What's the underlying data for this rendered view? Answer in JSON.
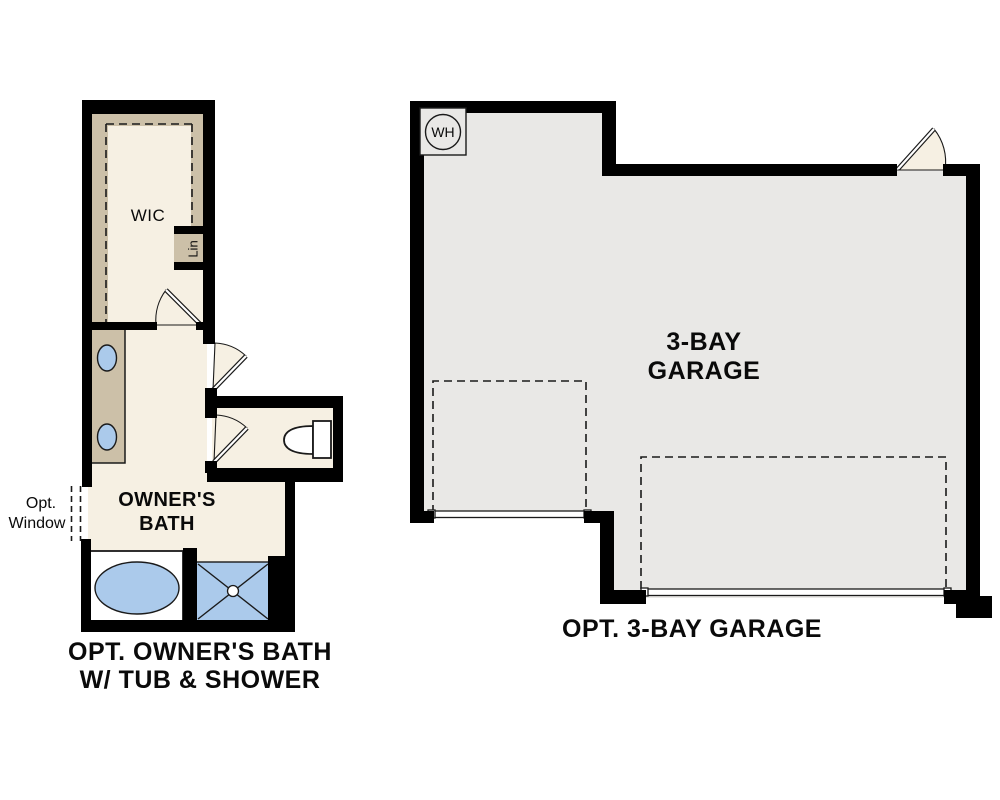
{
  "colors": {
    "wall": "#000000",
    "line-dark": "#1a1a1a",
    "floor-cream": "#f6f0e3",
    "closet-tan": "#ccc0a8",
    "garage-gray": "#e9e8e6",
    "fixture-blue": "#abcaeb"
  },
  "bath_plan": {
    "wic_label": "WIC",
    "linen_label": "Lin",
    "room_name_line1": "OWNER'S",
    "room_name_line2": "BATH",
    "window_note_line1": "Opt.",
    "window_note_line2": "Window",
    "caption_line1": "OPT. OWNER'S BATH",
    "caption_line2": "W/ TUB & SHOWER"
  },
  "garage_plan": {
    "water_heater_label": "WH",
    "room_name_line1": "3-BAY",
    "room_name_line2": "GARAGE",
    "caption": "OPT. 3-BAY GARAGE"
  }
}
